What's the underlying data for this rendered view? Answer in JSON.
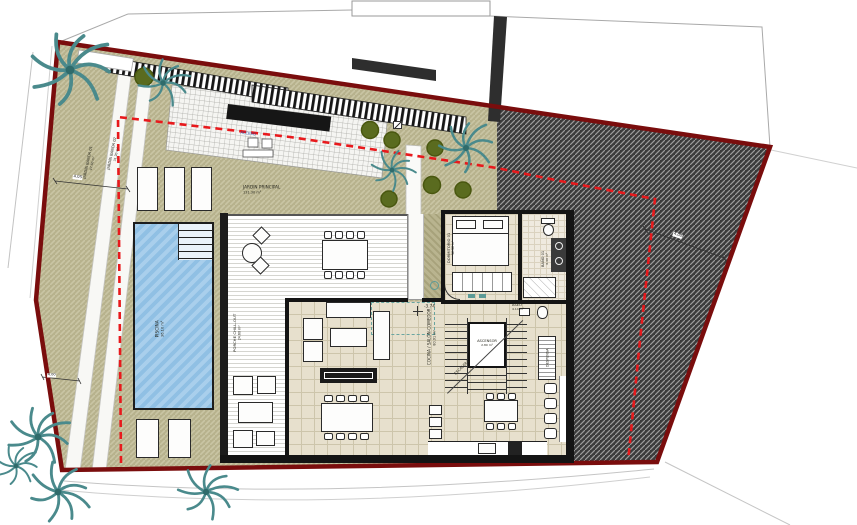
{
  "site": {
    "garden_main": {
      "label": "JARDÍN PRINCIPAL",
      "area": "131.30 m²"
    },
    "garden_band_1": {
      "label": "JARDÍN BANDA 01",
      "area": "47.60 m²"
    },
    "garden_band_2": {
      "label": "JARDÍN BANDA 02",
      "area": "31.20 m²"
    },
    "pergola_label": "PÉRGOLA",
    "access_label": "ACCESO",
    "dim_paths": "4.05",
    "dim_left": "4.00",
    "dim_right": "4.00"
  },
  "house": {
    "pool": {
      "label": "PISCINA",
      "area": "36.10 m²"
    },
    "porch": {
      "label": "PORCHE CHILL-OUT",
      "area": "24.60 m²"
    },
    "living": {
      "label": "COCINA / SALÓN-COMEDOR",
      "area": "80.91 m²",
      "level": "-3.74"
    },
    "bedroom": {
      "label": "DORMITORIO 01",
      "area": "16.38 m²"
    },
    "bath": {
      "label": "BAÑO 01",
      "area": "6.40 m²"
    },
    "aseo": {
      "label": "ASEO",
      "area": "4.14 m²"
    },
    "elevator": {
      "label": "ASCENSOR",
      "area": "2.80 m²"
    },
    "stairs_label": "ESCALERA",
    "pantry_label": "DESPENSA"
  },
  "colors": {
    "boundary": "#7a0d0d",
    "setback": "#e8191c",
    "garden": "#b7b28d",
    "pool": "#9cc6e8",
    "neighbor_hatch": "#3b3b3b",
    "palm": "#4a8a8c",
    "shrub": "#5a6b1f",
    "floor": "#e7e0cd"
  }
}
